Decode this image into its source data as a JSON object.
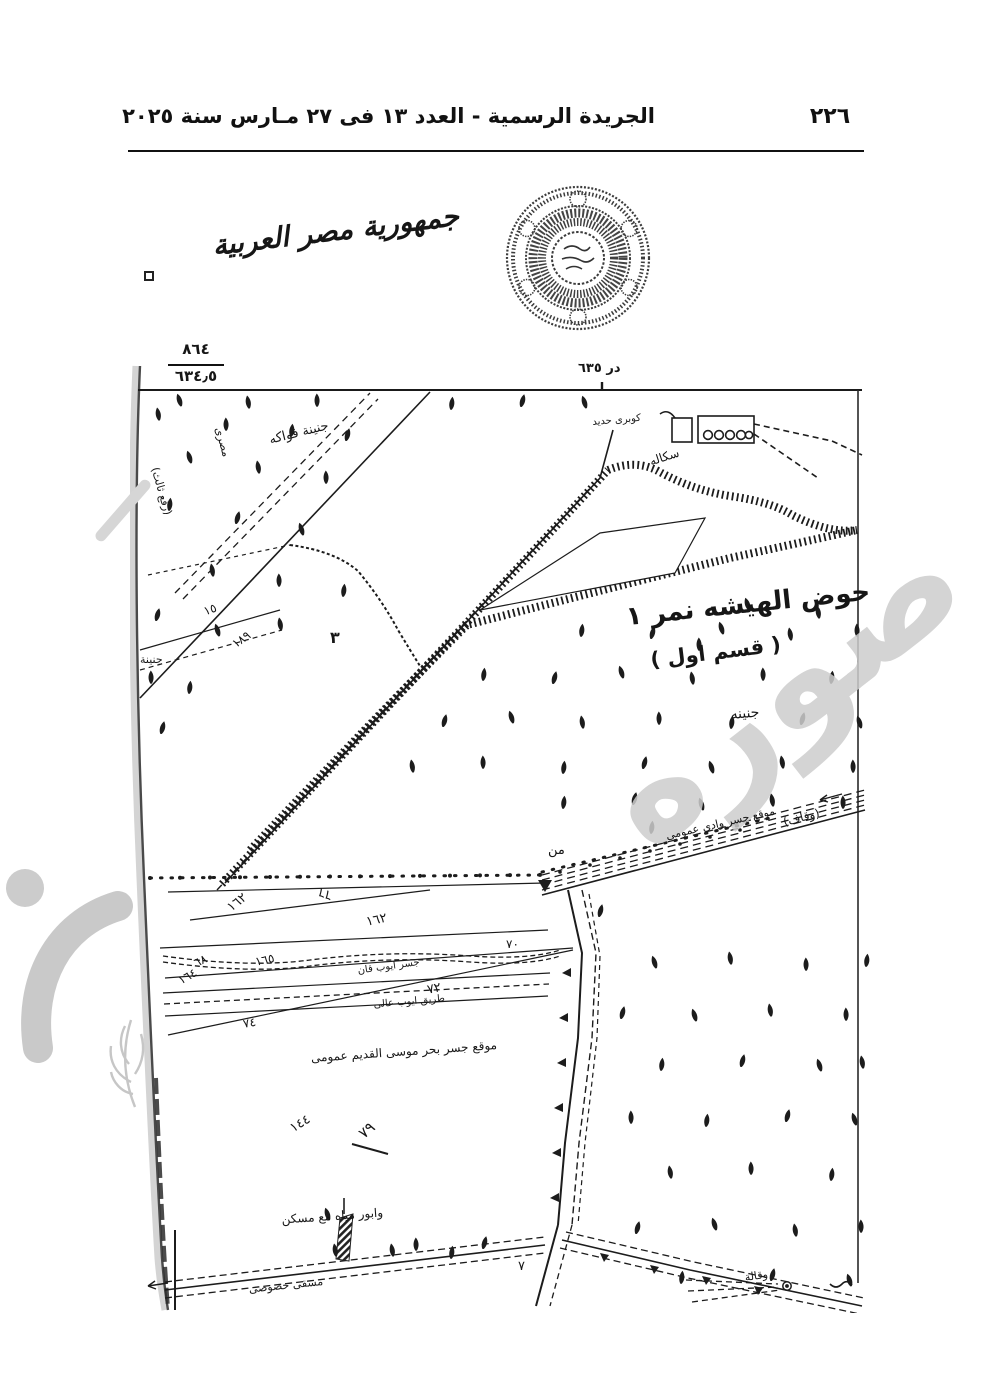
{
  "header": {
    "page_number": "٢٢٦",
    "title": "الجريدة الرسمية - العدد ١٣ فى ٢٧ مـارس سنة ٢٠٢٥"
  },
  "map": {
    "country_title": "جمهورية مصر العربية",
    "scale_fraction": {
      "top": "٨٦٤",
      "bottom": "٦٣٤٫٥"
    },
    "labels": {
      "datum_mark": "در ٦٣٥",
      "iron_bridge": "كوبرى حديد",
      "scala": "سكاله",
      "hod_title": "حوض الهيشه نمر ١",
      "section": "( قسم اول )",
      "garden_small": "جنينه",
      "garden_left": "جنينة",
      "fruit_garden": "جنينة فواكه",
      "third_lift": "(رفع ثالث)",
      "masry": "مصرى",
      "waqf": "(وقاف)",
      "min": "من",
      "bridge_site": "موقع جسر وادى عمومى",
      "canal_ayoub": "جسر ايوب قان",
      "road_ayoub": "طريق ايوب عالى",
      "old_bridge_site": "موقع جسر بحر موسى القديم عمومى",
      "water_pump": "وابور مياه مع مسكن",
      "private_canal": "مسقى خصوصى",
      "wekala": "وقالة"
    },
    "plot_numbers": {
      "n3": "٣",
      "n15": "١٥",
      "n189": "١٨٩",
      "n162a": "١٦٢",
      "n66": "٦٦",
      "n162b": "١٦٢",
      "n70": "٧٠",
      "n68": "٦٨",
      "n165": "١٦٥",
      "n164": "١٦٤",
      "n72": "٧٢",
      "n74": "٧٤",
      "n144": "١٤٤",
      "n79": "٧٩",
      "n7": "٧"
    }
  },
  "watermark": {
    "copy_text": "صوره"
  }
}
